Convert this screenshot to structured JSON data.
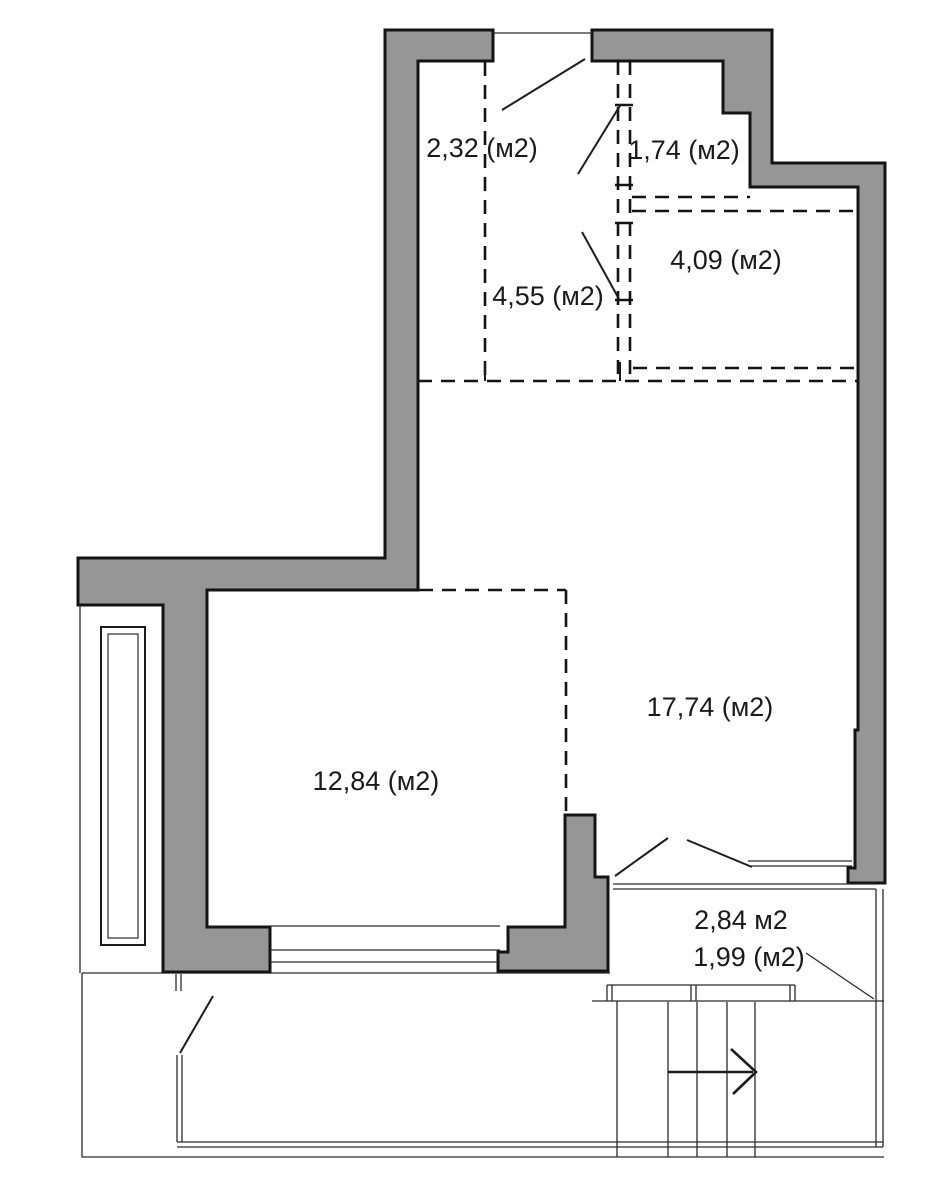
{
  "meta": {
    "drawing_type": "apartment floor plan",
    "area_unit": "м2"
  },
  "colors": {
    "background": "#ffffff",
    "wall_fill": "#969696",
    "outline": "#141414",
    "thin_line": "#2b2b2b",
    "text": "#1a1a1a"
  },
  "rooms": [
    {
      "label": "2,32 (м2)"
    },
    {
      "label": "1,74 (м2)"
    },
    {
      "label": "4,55 (м2)"
    },
    {
      "label": "4,09 (м2)"
    },
    {
      "label": "17,74 (м2)"
    },
    {
      "label": "12,84 (м2)"
    },
    {
      "label": "2,84 м2"
    },
    {
      "label": "1,99 (м2)"
    }
  ],
  "icons": {
    "stairs_arrow": "stairs-direction-arrow"
  }
}
